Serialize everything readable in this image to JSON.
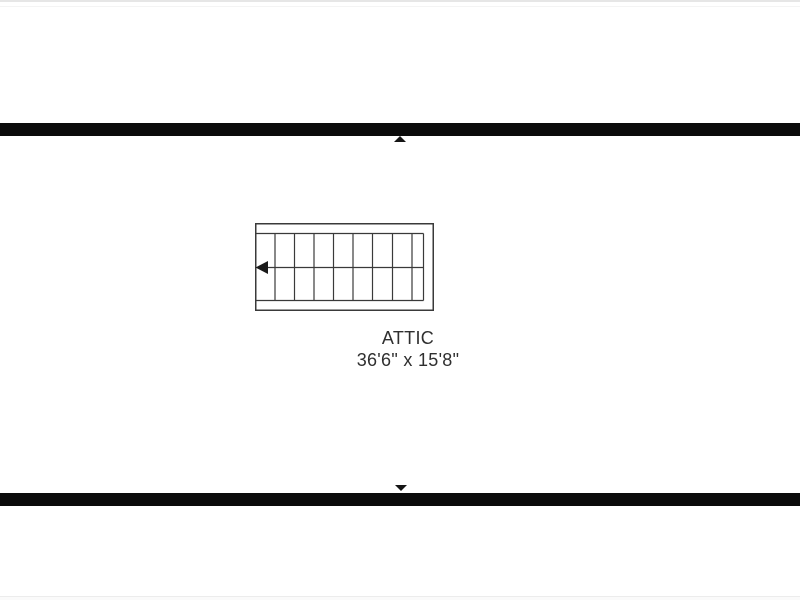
{
  "colors": {
    "wall": "#0b0b0b",
    "stair_line": "#3a3a3a",
    "stair_arrow": "#1a1a1a",
    "label_text": "#2f2f2f",
    "marker": "#151515",
    "chrome_edge": "#e6e6e6",
    "background": "#ffffff"
  },
  "floorplan": {
    "room": {
      "name": "ATTIC",
      "dimensions": "36'6\" x 15'8\""
    },
    "markers": {
      "top_direction": "up",
      "bottom_direction": "down"
    },
    "staircase": {
      "width": 179,
      "height": 88,
      "inner_top": 10.5,
      "inner_bottom": 77.5,
      "inner_right": 168.5,
      "tread_xs": [
        20,
        39.5,
        59,
        78.5,
        98,
        117.5,
        137.5,
        157
      ],
      "center_line_y": 44.5,
      "arrow_direction": "left",
      "arrow": {
        "tip_x": 0.5,
        "base_x": 13,
        "top_y": 38,
        "bottom_y": 51
      }
    }
  }
}
